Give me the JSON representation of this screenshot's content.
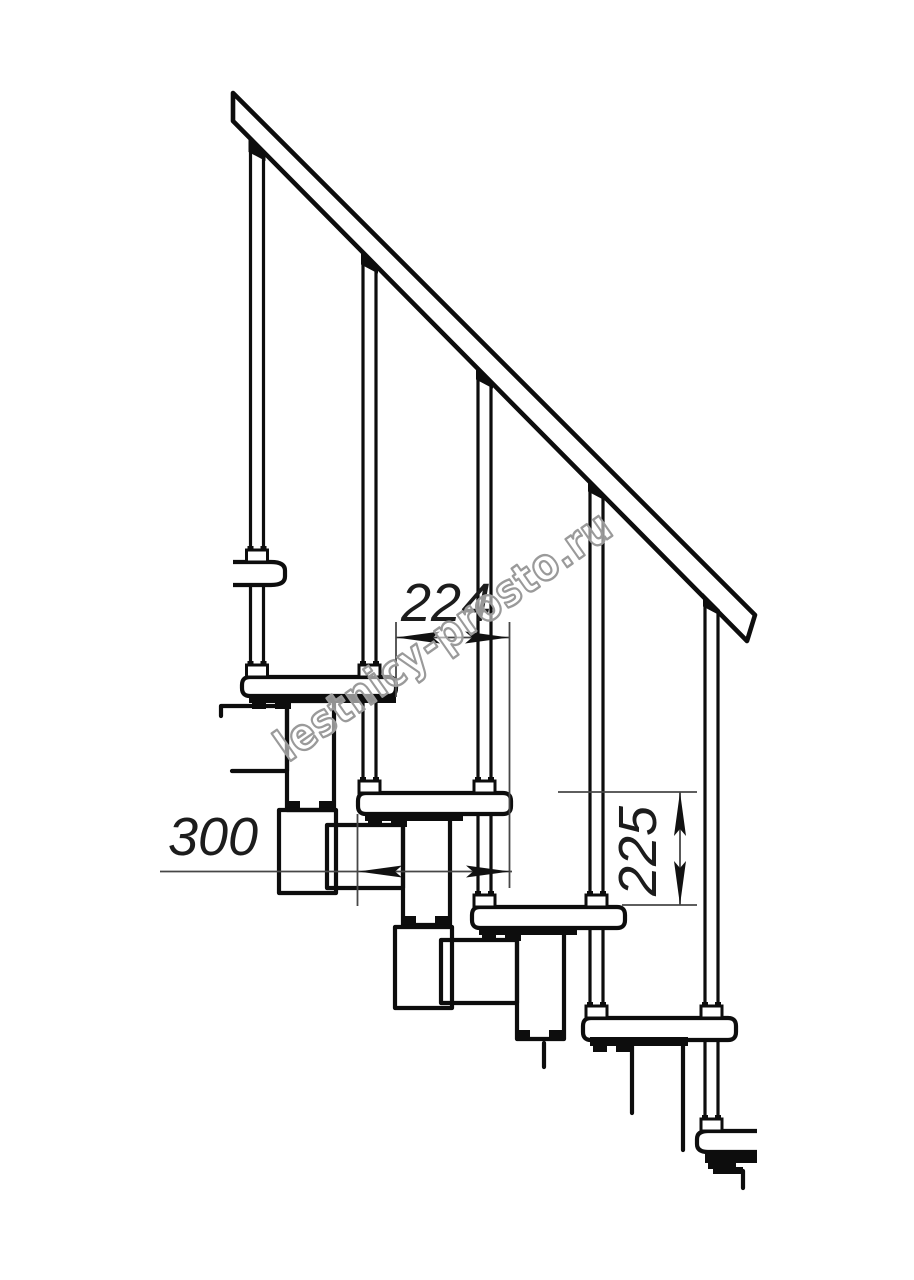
{
  "drawing": {
    "watermark": "lestnicy-prosto.ru",
    "dimensions": {
      "going_mm": "224",
      "tread_depth_mm": "300",
      "rise_mm": "225"
    },
    "colors": {
      "line": "#0d0d0d",
      "dim_line": "#474747",
      "dim_text": "#1c1c1c",
      "watermark": "#9a9a9a",
      "background": "#ffffff"
    }
  }
}
